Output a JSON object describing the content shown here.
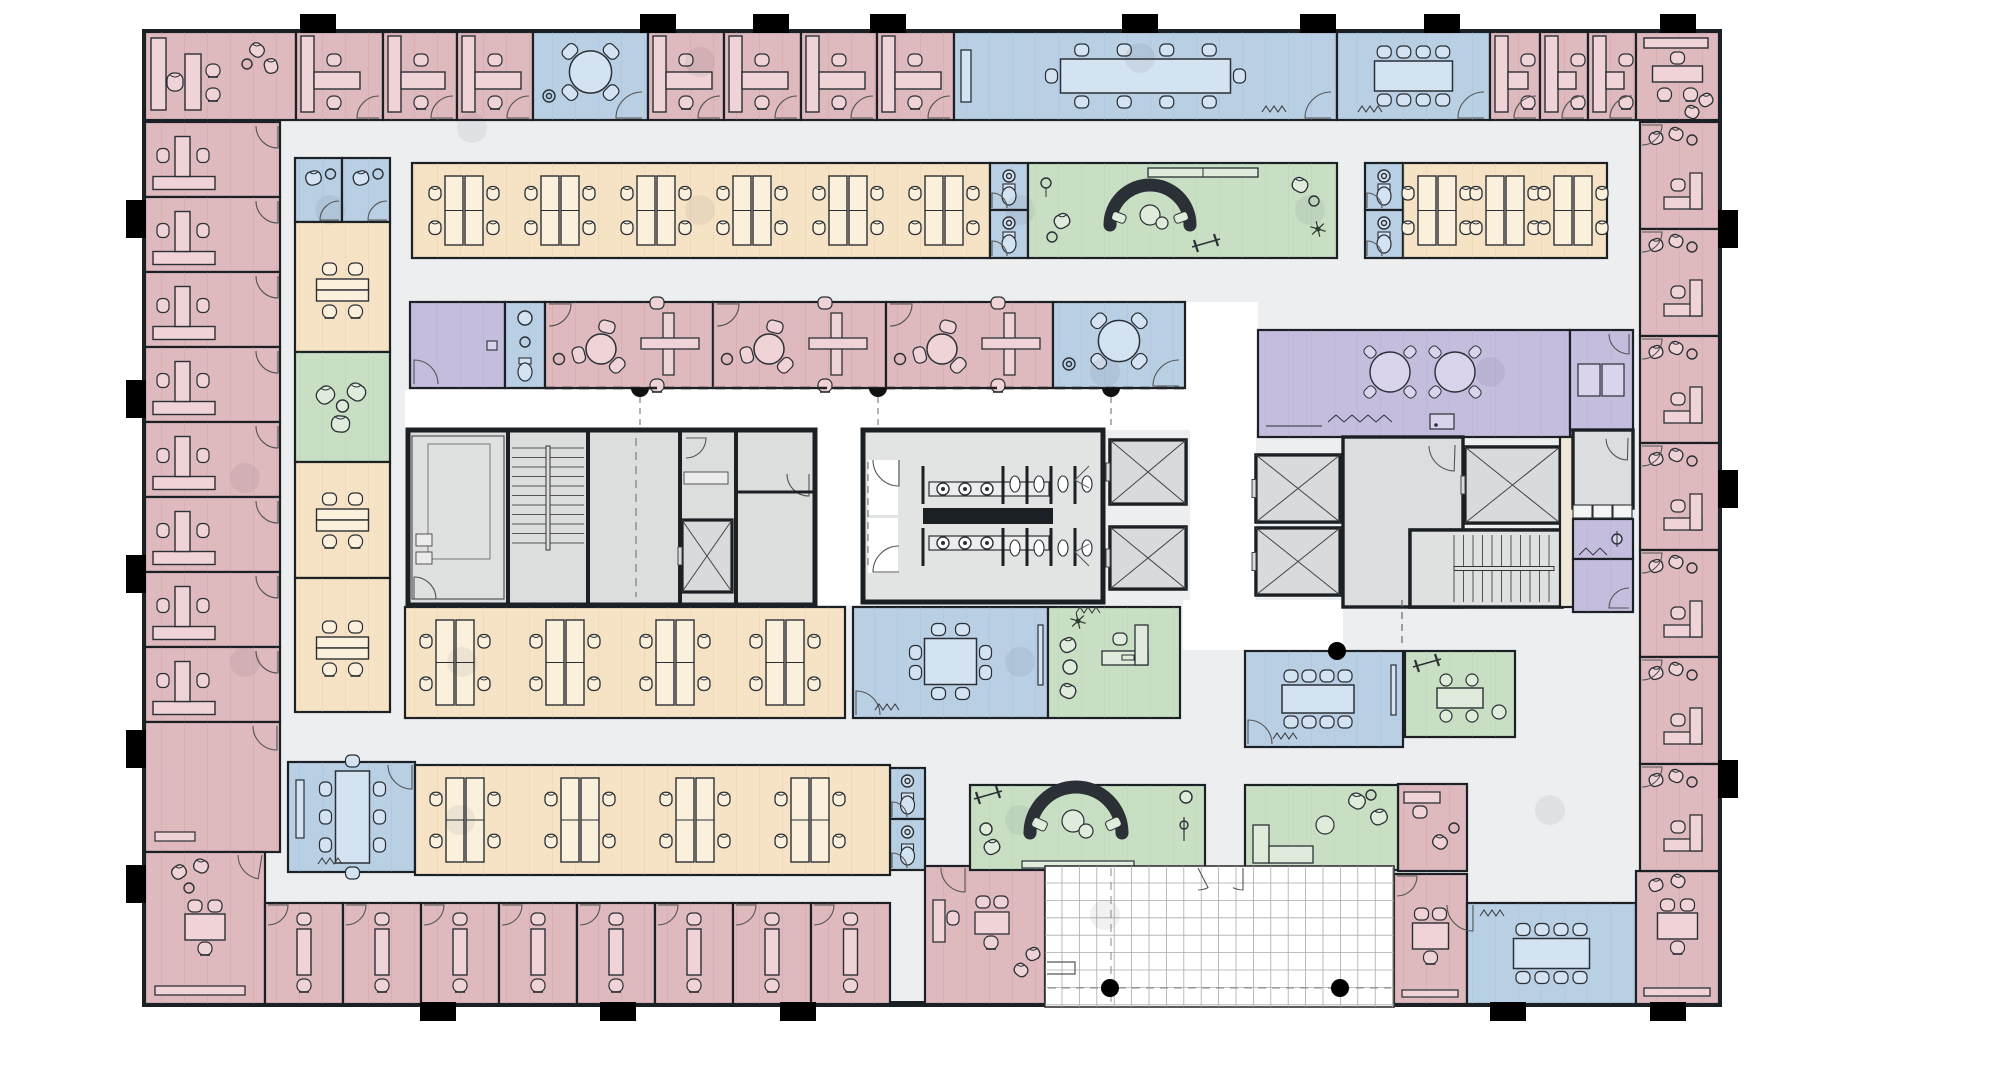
{
  "title": "office-floor-plan",
  "canvas": {
    "w": 2002,
    "h": 1069
  },
  "palette": {
    "wall": "#1b2025",
    "floor": "#edeef0",
    "white": "#ffffff",
    "furnStroke": "#2b3036",
    "pink": {
      "fill": "#deb9bd",
      "line": "#c5969c",
      "fu": "#efd3d6"
    },
    "orange": {
      "fill": "#f6e3c5",
      "line": "#ddbf94",
      "fu": "#fbf0dc"
    },
    "blue": {
      "fill": "#b9cfe4",
      "line": "#93b6d7",
      "fu": "#d4e3f2"
    },
    "green": {
      "fill": "#c8dfc4",
      "line": "#a7cca1",
      "fu": "#dfecdb"
    },
    "purple": {
      "fill": "#c5bdde",
      "line": "#a89ecc",
      "fu": "#d9d4eb"
    },
    "gray": {
      "fill": "#dcddde",
      "line": "#bbbcbd",
      "fu": "#ececec"
    },
    "beige": {
      "fill": "#efe8d8",
      "line": "#d8cdb4",
      "fu": "#f6f1e6"
    }
  },
  "building": {
    "x": 145,
    "y": 32,
    "w": 1574,
    "h": 972
  },
  "rooms": [
    {
      "id": "corner-office-nw",
      "t": "execTL",
      "x": 145,
      "y": 32,
      "w": 151,
      "h": 88
    },
    {
      "id": "office-n-1",
      "t": "offTop",
      "x": 296,
      "y": 32,
      "w": 87,
      "h": 88
    },
    {
      "id": "office-n-2",
      "t": "offTop",
      "x": 383,
      "y": 32,
      "w": 74,
      "h": 88
    },
    {
      "id": "office-n-3",
      "t": "offTop",
      "x": 457,
      "y": 32,
      "w": 76,
      "h": 88
    },
    {
      "id": "huddle-room-n",
      "t": "huddle",
      "x": 533,
      "y": 32,
      "w": 115,
      "h": 88
    },
    {
      "id": "office-n-4",
      "t": "offTop",
      "x": 648,
      "y": 32,
      "w": 76,
      "h": 88
    },
    {
      "id": "office-n-5",
      "t": "offTop",
      "x": 724,
      "y": 32,
      "w": 77,
      "h": 88
    },
    {
      "id": "office-n-6",
      "t": "offTop",
      "x": 801,
      "y": 32,
      "w": 76,
      "h": 88
    },
    {
      "id": "office-n-7",
      "t": "offTop",
      "x": 877,
      "y": 32,
      "w": 77,
      "h": 88
    },
    {
      "id": "conference-room-n1",
      "t": "conf",
      "x": 954,
      "y": 32,
      "w": 383,
      "h": 88,
      "o": {
        "tw": 170,
        "th": 34,
        "nt": 4,
        "nb": 4,
        "ends": 1,
        "wb": "l",
        "door": "br",
        "sq": [
          1262,
          112
        ]
      }
    },
    {
      "id": "conference-room-n2",
      "t": "conf",
      "x": 1337,
      "y": 32,
      "w": 153,
      "h": 88,
      "o": {
        "tw": 78,
        "th": 30,
        "nt": 4,
        "nb": 4,
        "door": "br",
        "sq": [
          1358,
          112
        ]
      }
    },
    {
      "id": "office-n-8",
      "t": "offTop",
      "x": 1490,
      "y": 32,
      "w": 50,
      "h": 88
    },
    {
      "id": "office-n-9",
      "t": "offTop",
      "x": 1540,
      "y": 32,
      "w": 48,
      "h": 88
    },
    {
      "id": "office-n-10",
      "t": "offTop",
      "x": 1588,
      "y": 32,
      "w": 48,
      "h": 88
    },
    {
      "id": "corner-office-ne",
      "t": "execTR",
      "x": 1636,
      "y": 32,
      "w": 83,
      "h": 88
    },
    {
      "id": "office-w-1",
      "t": "offLeft",
      "x": 145,
      "y": 122,
      "w": 135,
      "h": 75
    },
    {
      "id": "office-w-2",
      "t": "offLeft",
      "x": 145,
      "y": 197,
      "w": 135,
      "h": 75
    },
    {
      "id": "office-w-3",
      "t": "offLeft",
      "x": 145,
      "y": 272,
      "w": 135,
      "h": 75
    },
    {
      "id": "office-w-4",
      "t": "offLeft",
      "x": 145,
      "y": 347,
      "w": 135,
      "h": 75
    },
    {
      "id": "office-w-5",
      "t": "offLeft",
      "x": 145,
      "y": 422,
      "w": 135,
      "h": 75
    },
    {
      "id": "office-w-6",
      "t": "offLeft",
      "x": 145,
      "y": 497,
      "w": 135,
      "h": 75
    },
    {
      "id": "office-w-7",
      "t": "offLeft",
      "x": 145,
      "y": 572,
      "w": 135,
      "h": 75
    },
    {
      "id": "office-w-8",
      "t": "offLeft",
      "x": 145,
      "y": 647,
      "w": 135,
      "h": 75
    },
    {
      "id": "office-w-9",
      "t": "offPlain",
      "x": 145,
      "y": 722,
      "w": 135,
      "h": 130
    },
    {
      "id": "corner-office-sw",
      "t": "execBL",
      "x": 145,
      "y": 852,
      "w": 120,
      "h": 152
    },
    {
      "id": "office-s-1",
      "t": "offBottom",
      "x": 265,
      "y": 903,
      "w": 78,
      "h": 101
    },
    {
      "id": "office-s-2",
      "t": "offBottom",
      "x": 343,
      "y": 903,
      "w": 78,
      "h": 101
    },
    {
      "id": "office-s-3",
      "t": "offBottom",
      "x": 421,
      "y": 903,
      "w": 78,
      "h": 101
    },
    {
      "id": "office-s-4",
      "t": "offBottom",
      "x": 499,
      "y": 903,
      "w": 78,
      "h": 101
    },
    {
      "id": "office-s-5",
      "t": "offBottom",
      "x": 577,
      "y": 903,
      "w": 78,
      "h": 101
    },
    {
      "id": "office-s-6",
      "t": "offBottom",
      "x": 655,
      "y": 903,
      "w": 78,
      "h": 101
    },
    {
      "id": "office-s-7",
      "t": "offBottom",
      "x": 733,
      "y": 903,
      "w": 78,
      "h": 101
    },
    {
      "id": "office-s-8",
      "t": "offBottom",
      "x": 811,
      "y": 903,
      "w": 79,
      "h": 101
    },
    {
      "id": "wc-s-1",
      "t": "wc",
      "x": 890,
      "y": 768,
      "w": 35,
      "h": 51
    },
    {
      "id": "wc-s-2",
      "t": "wc",
      "x": 890,
      "y": 819,
      "w": 35,
      "h": 51
    },
    {
      "id": "office-s-wide",
      "t": "pinkWide",
      "x": 925,
      "y": 866,
      "w": 120,
      "h": 138
    },
    {
      "id": "office-s-table",
      "t": "offTable",
      "x": 1394,
      "y": 874,
      "w": 73,
      "h": 130
    },
    {
      "id": "conference-room-s",
      "t": "conf",
      "x": 1467,
      "y": 903,
      "w": 169,
      "h": 101,
      "o": {
        "tw": 76,
        "th": 30,
        "nt": 4,
        "nb": 4,
        "door": "tl",
        "sq": [
          1480,
          916
        ]
      }
    },
    {
      "id": "corner-office-se",
      "t": "execBR",
      "x": 1636,
      "y": 871,
      "w": 83,
      "h": 133
    },
    {
      "id": "office-e-1",
      "t": "offRight",
      "x": 1640,
      "y": 122,
      "w": 79,
      "h": 107
    },
    {
      "id": "office-e-2",
      "t": "offRight",
      "x": 1640,
      "y": 229,
      "w": 79,
      "h": 107
    },
    {
      "id": "office-e-3",
      "t": "offRight",
      "x": 1640,
      "y": 336,
      "w": 79,
      "h": 107
    },
    {
      "id": "office-e-4",
      "t": "offRight",
      "x": 1640,
      "y": 443,
      "w": 79,
      "h": 107
    },
    {
      "id": "office-e-5",
      "t": "offRight",
      "x": 1640,
      "y": 550,
      "w": 79,
      "h": 107
    },
    {
      "id": "office-e-6",
      "t": "offRight",
      "x": 1640,
      "y": 657,
      "w": 79,
      "h": 107
    },
    {
      "id": "office-e-7",
      "t": "offRight",
      "x": 1640,
      "y": 764,
      "w": 79,
      "h": 107
    },
    {
      "id": "phone-booth-1",
      "t": "booth",
      "x": 295,
      "y": 158,
      "w": 47,
      "h": 64
    },
    {
      "id": "phone-booth-2",
      "t": "booth",
      "x": 342,
      "y": 158,
      "w": 48,
      "h": 64
    },
    {
      "id": "team-table-1",
      "t": "stripTable",
      "x": 295,
      "y": 222,
      "w": 95,
      "h": 130,
      "o": {
        "ty": 290
      }
    },
    {
      "id": "lounge-nook",
      "t": "lounge3",
      "x": 295,
      "y": 352,
      "w": 95,
      "h": 110
    },
    {
      "id": "team-table-2",
      "t": "stripTable",
      "x": 295,
      "y": 462,
      "w": 95,
      "h": 116,
      "o": {
        "ty": 520
      }
    },
    {
      "id": "team-table-3",
      "t": "stripTable",
      "x": 295,
      "y": 578,
      "w": 95,
      "h": 134,
      "o": {
        "ty": 648
      }
    },
    {
      "id": "open-office-n",
      "t": "openOffice",
      "x": 412,
      "y": 163,
      "w": 578,
      "h": 95,
      "o": {
        "cx": [
          464,
          560,
          656,
          752,
          848,
          944
        ]
      }
    },
    {
      "id": "wc-n-1",
      "t": "wc",
      "x": 990,
      "y": 163,
      "w": 38,
      "h": 47
    },
    {
      "id": "wc-n-2",
      "t": "wc",
      "x": 990,
      "y": 210,
      "w": 38,
      "h": 48
    },
    {
      "id": "lounge-n",
      "t": "greenLoungeTop",
      "x": 1028,
      "y": 163,
      "w": 309,
      "h": 95
    },
    {
      "id": "wc-n-3",
      "t": "wc",
      "x": 1365,
      "y": 163,
      "w": 38,
      "h": 47
    },
    {
      "id": "wc-n-4",
      "t": "wc",
      "x": 1365,
      "y": 210,
      "w": 38,
      "h": 48
    },
    {
      "id": "open-office-ne",
      "t": "openOffice",
      "x": 1403,
      "y": 163,
      "w": 204,
      "h": 95,
      "o": {
        "cx": [
          1437,
          1505,
          1573
        ]
      }
    },
    {
      "id": "copy-room",
      "t": "purpleRoom",
      "x": 410,
      "y": 302,
      "w": 95,
      "h": 86
    },
    {
      "id": "wc-mid",
      "t": "wcTall",
      "x": 505,
      "y": 302,
      "w": 40,
      "h": 86
    },
    {
      "id": "meeting-office-1",
      "t": "meetOffice",
      "x": 545,
      "y": 302,
      "w": 168,
      "h": 86
    },
    {
      "id": "meeting-office-2",
      "t": "meetOffice",
      "x": 713,
      "y": 302,
      "w": 173,
      "h": 86
    },
    {
      "id": "meeting-office-3",
      "t": "meetOffice",
      "x": 886,
      "y": 302,
      "w": 167,
      "h": 86
    },
    {
      "id": "huddle-room-mid",
      "t": "huddle",
      "x": 1053,
      "y": 302,
      "w": 132,
      "h": 86
    },
    {
      "id": "collab-cafe",
      "t": "purpleCollab",
      "x": 1258,
      "y": 330,
      "w": 312,
      "h": 107
    },
    {
      "id": "storage-room",
      "t": "purpleStore",
      "x": 1570,
      "y": 330,
      "w": 63,
      "h": 100
    },
    {
      "id": "core-west",
      "t": "coreL",
      "x": 408,
      "y": 430,
      "w": 407,
      "h": 175
    },
    {
      "id": "restrooms",
      "t": "restrooms",
      "x": 863,
      "y": 430,
      "w": 240,
      "h": 172
    },
    {
      "id": "elevator-1",
      "t": "shaft",
      "x": 1110,
      "y": 440,
      "w": 76,
      "h": 64
    },
    {
      "id": "elevator-2",
      "t": "shaft",
      "x": 1110,
      "y": 527,
      "w": 76,
      "h": 62
    },
    {
      "id": "elevator-3",
      "t": "shaft",
      "x": 1256,
      "y": 455,
      "w": 84,
      "h": 67
    },
    {
      "id": "elevator-4",
      "t": "shaft",
      "x": 1256,
      "y": 528,
      "w": 84,
      "h": 67
    },
    {
      "id": "elevator-lobby-e",
      "t": "grayRoom",
      "x": 1343,
      "y": 437,
      "w": 120,
      "h": 170,
      "o": {
        "doors": [
          [
            1455,
            445,
            26,
            1.6,
            3.1
          ],
          [
            1455,
            560,
            24,
            -1.6,
            0
          ]
        ]
      }
    },
    {
      "id": "elevator-5",
      "t": "shaft",
      "x": 1465,
      "y": 447,
      "w": 95,
      "h": 76
    },
    {
      "id": "stair-east",
      "t": "stairsH",
      "x": 1410,
      "y": 530,
      "w": 152,
      "h": 77
    },
    {
      "id": "shaft-gap",
      "t": "beige",
      "x": 1560,
      "y": 437,
      "w": 14,
      "h": 170
    },
    {
      "id": "store-e-1",
      "t": "grayRoom",
      "x": 1573,
      "y": 430,
      "w": 60,
      "h": 78,
      "o": {
        "doors": [
          [
            1628,
            438,
            22,
            1.6,
            3.1
          ]
        ]
      }
    },
    {
      "id": "shelves-e",
      "t": "shelfRow",
      "x": 1573,
      "y": 505,
      "w": 60,
      "h": 14
    },
    {
      "id": "janitor",
      "t": "purpleSmall",
      "x": 1573,
      "y": 519,
      "w": 60,
      "h": 40
    },
    {
      "id": "store-e-2",
      "t": "purpleDoor",
      "x": 1573,
      "y": 559,
      "w": 60,
      "h": 53
    },
    {
      "id": "open-office-w",
      "t": "openOffice",
      "x": 405,
      "y": 607,
      "w": 440,
      "h": 111,
      "o": {
        "cx": [
          455,
          565,
          675,
          785
        ]
      }
    },
    {
      "id": "meeting-room-8",
      "t": "conf8",
      "x": 853,
      "y": 607,
      "w": 195,
      "h": 111
    },
    {
      "id": "manager-office",
      "t": "greenOffice",
      "x": 1048,
      "y": 607,
      "w": 132,
      "h": 111
    },
    {
      "id": "conference-room-e",
      "t": "conf12",
      "x": 1245,
      "y": 651,
      "w": 158,
      "h": 96
    },
    {
      "id": "dining-room",
      "t": "greenDining",
      "x": 1405,
      "y": 651,
      "w": 110,
      "h": 86
    },
    {
      "id": "office-lounge-e",
      "t": "offLounge",
      "x": 1398,
      "y": 784,
      "w": 69,
      "h": 87
    },
    {
      "id": "meeting-room-sw",
      "t": "conf8v",
      "x": 288,
      "y": 762,
      "w": 127,
      "h": 110
    },
    {
      "id": "open-office-s",
      "t": "openOffice",
      "x": 415,
      "y": 765,
      "w": 475,
      "h": 110,
      "o": {
        "cx": [
          465,
          580,
          695,
          810
        ]
      }
    },
    {
      "id": "wellness-lounge",
      "t": "greenWellness",
      "x": 970,
      "y": 785,
      "w": 235,
      "h": 85
    },
    {
      "id": "lounge-se",
      "t": "greenLoungeB",
      "x": 1245,
      "y": 785,
      "w": 153,
      "h": 85
    },
    {
      "id": "terrace",
      "t": "terrace",
      "x": 1045,
      "y": 866,
      "w": 349,
      "h": 141
    }
  ],
  "whiteAreas": [
    [
      815,
      430,
      48,
      175
    ],
    [
      1190,
      430,
      66,
      177
    ],
    [
      1183,
      600,
      160,
      50
    ],
    [
      405,
      390,
      780,
      40
    ],
    [
      1185,
      302,
      73,
      128
    ]
  ],
  "stubs": {
    "top": [
      300,
      640,
      753,
      870,
      1122,
      1300,
      1424,
      1660
    ],
    "bottom": [
      420,
      600,
      780,
      1490,
      1650
    ],
    "left": [
      200,
      380,
      555,
      730,
      865
    ],
    "right": [
      210,
      470,
      760
    ]
  },
  "columnDots": [
    [
      472,
      128
    ],
    [
      700,
      62
    ],
    [
      1140,
      58
    ],
    [
      330,
      210
    ],
    [
      1020,
      210
    ],
    [
      1310,
      210
    ],
    [
      245,
      478
    ],
    [
      462,
      662
    ],
    [
      1020,
      662
    ],
    [
      1105,
      372
    ],
    [
      1490,
      372
    ],
    [
      460,
      820
    ],
    [
      1020,
      820
    ],
    [
      1550,
      810
    ],
    [
      245,
      662
    ],
    [
      1105,
      915
    ],
    [
      700,
      210
    ]
  ],
  "dashedWall": {
    "y": 388,
    "x1": 545,
    "x2": 1185,
    "bumps": [
      640,
      878,
      1111
    ]
  },
  "terraceColumns": [
    [
      1110,
      988
    ],
    [
      1340,
      988
    ]
  ],
  "corridorColumn": [
    1337,
    651
  ]
}
